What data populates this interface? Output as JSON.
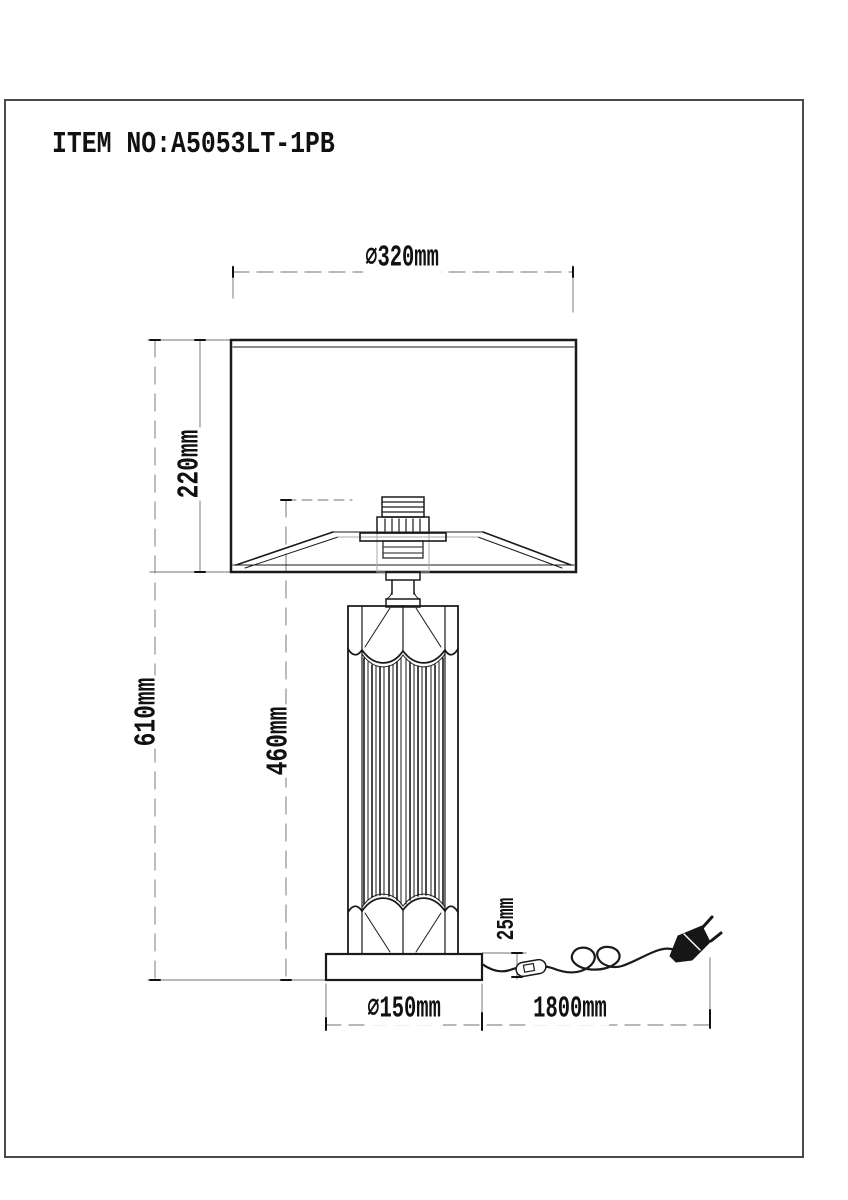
{
  "title": "ITEM NO:A5053LT-1PB",
  "colors": {
    "line": "#1a1a1a",
    "dimension": "#8f8f8f",
    "background": "#ffffff"
  },
  "dimensions": {
    "shade_diameter": "⌀320mm",
    "shade_height": "220mm",
    "total_height": "610mm",
    "body_height": "460mm",
    "base_height": "25mm",
    "base_diameter": "⌀150mm",
    "cord_length": "1800mm"
  }
}
